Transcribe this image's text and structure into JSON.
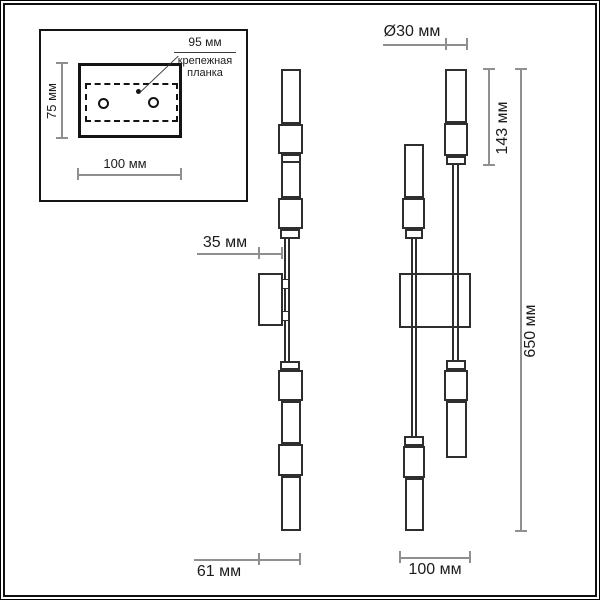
{
  "inset": {
    "bracket_width": "95 мм",
    "bracket_caption": [
      "крепежная",
      "планка"
    ],
    "plate_height": "75 мм",
    "plate_width": "100 мм"
  },
  "side_view": {
    "rod_offset": "35 мм",
    "fixture_depth": "61 мм"
  },
  "front_view": {
    "tube_diameter": "Ø30 мм",
    "head_length": "143 мм",
    "total_height": "650 мм",
    "plate_width": "100 мм"
  },
  "colors": {
    "outline": "#2e2e2e",
    "dimension_line": "#8f8f8f",
    "text": "#1c1c1c",
    "background": "#ffffff"
  }
}
